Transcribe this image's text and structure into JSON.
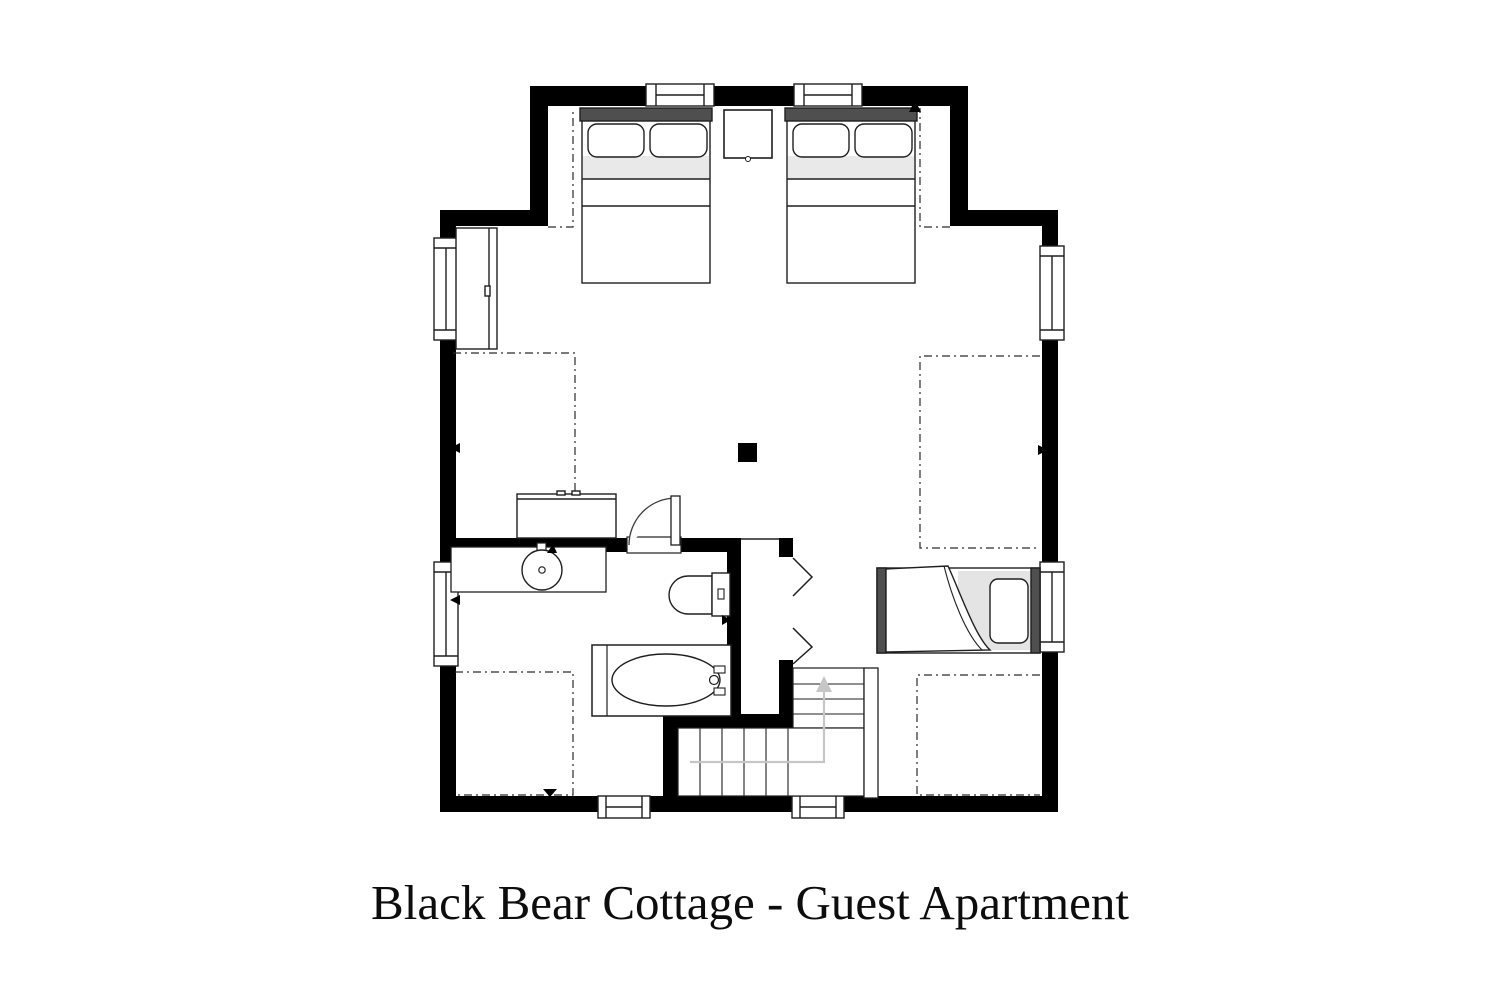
{
  "title": "Black Bear Cottage - Guest Apartment",
  "colors": {
    "wall": "#000000",
    "line": "#1f1f1f",
    "headboard_dark": "#4f4f4f",
    "bedding_shade": "#e9e9e9",
    "mattress_shade": "#e4e4e4",
    "stair_arrow": "#c6c6c6",
    "background": "#ffffff"
  },
  "plan": {
    "kind": "floor-plan",
    "symbols": [
      "double-bed-left",
      "double-bed-right",
      "nightstand",
      "wardrobe",
      "dresser",
      "bathroom-vanity-sink",
      "toilet",
      "bathtub",
      "single-bed",
      "bifold-closet-doors",
      "swing-door-bathroom",
      "staircase-with-up-arrow",
      "chimney-post",
      "window",
      "low-ceiling-dashed-zones"
    ],
    "window_count": 8
  }
}
